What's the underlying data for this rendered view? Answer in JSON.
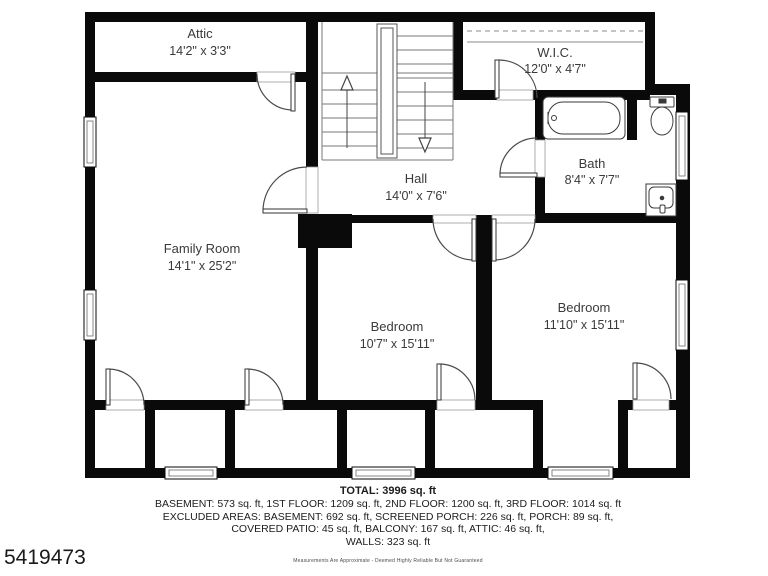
{
  "rooms": {
    "attic": {
      "name": "Attic",
      "dims": "14'2\" x 3'3\""
    },
    "wic": {
      "name": "W.I.C.",
      "dims": "12'0\" x 4'7\""
    },
    "bath": {
      "name": "Bath",
      "dims": "8'4\" x 7'7\""
    },
    "hall": {
      "name": "Hall",
      "dims": "14'0\" x 7'6\""
    },
    "family_room": {
      "name": "Family Room",
      "dims": "14'1\" x 25'2\""
    },
    "bedroom_mid": {
      "name": "Bedroom",
      "dims": "10'7\" x 15'11\""
    },
    "bedroom_right": {
      "name": "Bedroom",
      "dims": "11'10\" x 15'11\""
    }
  },
  "summary": {
    "total": "TOTAL: 3996 sq. ft",
    "lines": [
      "BASEMENT: 573 sq. ft, 1ST FLOOR: 1209 sq. ft, 2ND FLOOR: 1200 sq. ft, 3RD FLOOR: 1014 sq. ft",
      "EXCLUDED AREAS: BASEMENT: 692 sq. ft, SCREENED PORCH: 226 sq. ft, PORCH: 89 sq. ft,",
      "COVERED PATIO: 45 sq. ft, BALCONY: 167 sq. ft, ATTIC: 46 sq. ft,",
      "WALLS: 323 sq. ft"
    ],
    "disclaimer": "Measurements Are Approximate - Deemed Highly Reliable But Not Guaranteed"
  },
  "listing_id": "5419473",
  "colors": {
    "wall": "#0a0a0a",
    "label_text": "#3a3a3a",
    "summary_text": "#1c1c1c"
  }
}
